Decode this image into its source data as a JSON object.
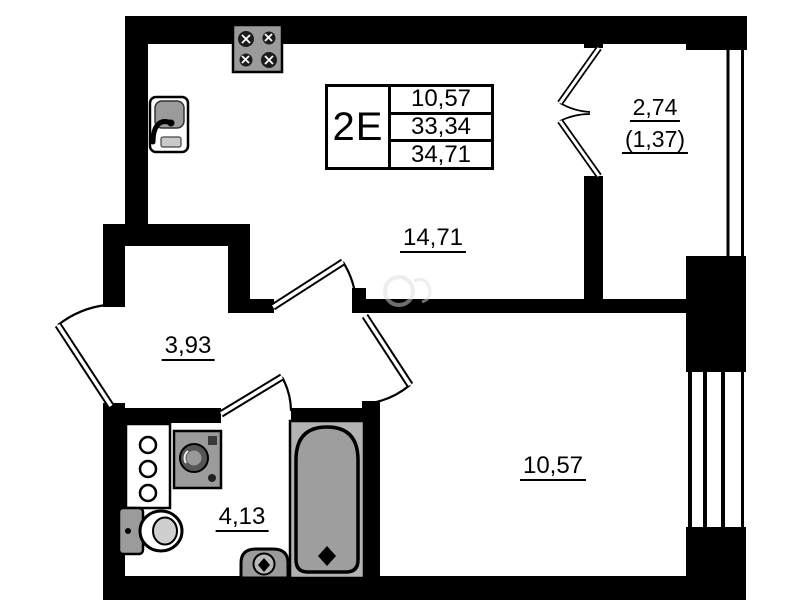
{
  "floor_plan": {
    "unit_card": {
      "unit_label": "2E",
      "areas": [
        "10,57",
        "33,34",
        "34,71"
      ]
    },
    "rooms": {
      "living_kitchen": {
        "area_label": "14,71"
      },
      "hallway": {
        "area_label": "3,93"
      },
      "bathroom": {
        "area_label": "4,13"
      },
      "bedroom": {
        "area_label": "10,57"
      },
      "balcony": {
        "area_label": "2,74",
        "area_label_reduced": "(1,37)"
      }
    },
    "palette": {
      "wall": "#000000",
      "fixture_gray": "#9b9b9b",
      "tub_gray": "#b3b3b3",
      "paper": "#ffffff"
    }
  }
}
